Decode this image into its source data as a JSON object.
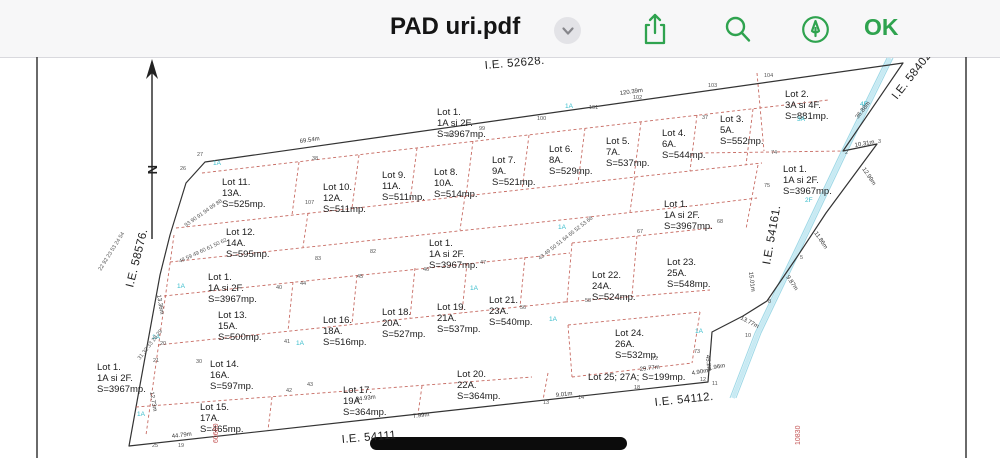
{
  "header": {
    "title": "PAD uri.pdf",
    "ok_label": "OK",
    "accent_green": "#2fa34f",
    "chevron_icon": "chevron-down-icon",
    "icons": [
      "share-icon",
      "search-icon",
      "markup-icon"
    ]
  },
  "map": {
    "north_label": "N",
    "street_labels": [
      {
        "text": "I.E. 52628.",
        "x": 485,
        "y": 12,
        "rot": -5
      },
      {
        "text": "I.E. 58402.",
        "x": 897,
        "y": 43,
        "rot": -52
      },
      {
        "text": "I.E. 58576.",
        "x": 133,
        "y": 231,
        "rot": -76
      },
      {
        "text": "I.E. 54161.",
        "x": 770,
        "y": 208,
        "rot": -80
      },
      {
        "text": "I.E. 54112.",
        "x": 655,
        "y": 349,
        "rot": -6
      },
      {
        "text": "I.E. 54111",
        "x": 342,
        "y": 386,
        "rot": -5
      }
    ],
    "red_labels": [
      {
        "text": "60660",
        "x": 218,
        "y": 386,
        "rot": -90
      },
      {
        "text": "10830",
        "x": 800,
        "y": 388,
        "rot": -90
      }
    ],
    "lot_labels": [
      {
        "x": 437,
        "y": 58,
        "lines": [
          "Lot 1.",
          "1A si 2F.",
          "S=3967mp."
        ]
      },
      {
        "x": 222,
        "y": 128,
        "lines": [
          "Lot 11.",
          "13A.",
          "S=525mp."
        ]
      },
      {
        "x": 323,
        "y": 133,
        "lines": [
          "Lot 10.",
          "12A.",
          "S=511mp."
        ]
      },
      {
        "x": 382,
        "y": 121,
        "lines": [
          "Lot 9.",
          "11A.",
          "S=511mp."
        ]
      },
      {
        "x": 434,
        "y": 118,
        "lines": [
          "Lot 8.",
          "10A.",
          "S=514mp."
        ]
      },
      {
        "x": 492,
        "y": 106,
        "lines": [
          "Lot 7.",
          "9A.",
          "S=521mp."
        ]
      },
      {
        "x": 549,
        "y": 95,
        "lines": [
          "Lot 6.",
          "8A.",
          "S=529mp."
        ]
      },
      {
        "x": 606,
        "y": 87,
        "lines": [
          "Lot 5.",
          "7A.",
          "S=537mp."
        ]
      },
      {
        "x": 662,
        "y": 79,
        "lines": [
          "Lot 4.",
          "6A.",
          "S=544mp."
        ]
      },
      {
        "x": 720,
        "y": 65,
        "lines": [
          "Lot 3.",
          "5A.",
          "S=552mp."
        ]
      },
      {
        "x": 785,
        "y": 40,
        "lines": [
          "Lot 2.",
          "3A si 4F.",
          "S=881mp."
        ]
      },
      {
        "x": 783,
        "y": 115,
        "lines": [
          "Lot 1.",
          "1A si 2F.",
          "S=3967mp."
        ]
      },
      {
        "x": 226,
        "y": 178,
        "lines": [
          "Lot 12.",
          "14A.",
          "S=595mp."
        ]
      },
      {
        "x": 664,
        "y": 150,
        "lines": [
          "Lot 1.",
          "1A si 2F.",
          "S=3967mp."
        ]
      },
      {
        "x": 429,
        "y": 189,
        "lines": [
          "Lot 1.",
          "1A si 2F.",
          "S=3967mp."
        ]
      },
      {
        "x": 208,
        "y": 223,
        "lines": [
          "Lot 1.",
          "1A si 2F.",
          "S=3967mp."
        ]
      },
      {
        "x": 592,
        "y": 221,
        "lines": [
          "Lot 22.",
          "24A.",
          "S=524mp."
        ]
      },
      {
        "x": 667,
        "y": 208,
        "lines": [
          "Lot 23.",
          "25A.",
          "S=548mp."
        ]
      },
      {
        "x": 218,
        "y": 261,
        "lines": [
          "Lot 13.",
          "15A.",
          "S=500mp."
        ]
      },
      {
        "x": 323,
        "y": 266,
        "lines": [
          "Lot 16.",
          "18A.",
          "S=516mp."
        ]
      },
      {
        "x": 382,
        "y": 258,
        "lines": [
          "Lot 18.",
          "20A.",
          "S=527mp."
        ]
      },
      {
        "x": 437,
        "y": 253,
        "lines": [
          "Lot 19.",
          "21A.",
          "S=537mp."
        ]
      },
      {
        "x": 489,
        "y": 246,
        "lines": [
          "Lot 21.",
          "23A.",
          "S=540mp."
        ]
      },
      {
        "x": 615,
        "y": 279,
        "lines": [
          "Lot 24.",
          "26A.",
          "S=532mp."
        ]
      },
      {
        "x": 210,
        "y": 310,
        "lines": [
          "Lot 14.",
          "16A.",
          "S=597mp."
        ]
      },
      {
        "x": 343,
        "y": 336,
        "lines": [
          "Lot 17.",
          "19A.",
          "S=364mp."
        ]
      },
      {
        "x": 457,
        "y": 320,
        "lines": [
          "Lot 20.",
          "22A.",
          "S=364mp."
        ]
      },
      {
        "x": 588,
        "y": 323,
        "lines": [
          "Lot 25; 27A; S=199mp."
        ]
      },
      {
        "x": 97,
        "y": 313,
        "lines": [
          "Lot 1.",
          "1A si 2F.",
          "S=3967mp."
        ]
      },
      {
        "x": 200,
        "y": 353,
        "lines": [
          "Lot 15.",
          "17A.",
          "S=465mp."
        ]
      }
    ],
    "zone_labels": [
      {
        "text": "1A",
        "x": 213,
        "y": 108
      },
      {
        "text": "1A",
        "x": 565,
        "y": 51
      },
      {
        "text": "1A",
        "x": 558,
        "y": 172
      },
      {
        "text": "1A",
        "x": 470,
        "y": 233
      },
      {
        "text": "1A",
        "x": 549,
        "y": 264
      },
      {
        "text": "1A",
        "x": 695,
        "y": 276
      },
      {
        "text": "1A",
        "x": 296,
        "y": 288
      },
      {
        "text": "1A",
        "x": 177,
        "y": 231
      },
      {
        "text": "1A",
        "x": 152,
        "y": 282
      },
      {
        "text": "1A",
        "x": 137,
        "y": 359
      },
      {
        "text": "2F",
        "x": 805,
        "y": 145
      },
      {
        "text": "3A",
        "x": 797,
        "y": 64
      },
      {
        "text": "4F",
        "x": 860,
        "y": 49
      }
    ],
    "measurements": [
      {
        "text": "69.54m",
        "x": 300,
        "y": 86,
        "rot": -8
      },
      {
        "text": "120.39m",
        "x": 620,
        "y": 38,
        "rot": -8
      },
      {
        "text": "36.88m",
        "x": 858,
        "y": 62,
        "rot": -52
      },
      {
        "text": "10.31m",
        "x": 855,
        "y": 90,
        "rot": -10
      },
      {
        "text": "12.99m",
        "x": 862,
        "y": 112,
        "rot": 56
      },
      {
        "text": "11.86m",
        "x": 814,
        "y": 176,
        "rot": 56
      },
      {
        "text": "9.87m",
        "x": 786,
        "y": 220,
        "rot": 56
      },
      {
        "text": "13.77m",
        "x": 740,
        "y": 262,
        "rot": 28
      },
      {
        "text": "15.01m",
        "x": 749,
        "y": 215,
        "rot": 83
      },
      {
        "text": "9.01m",
        "x": 556,
        "y": 340,
        "rot": -7
      },
      {
        "text": "34.93m",
        "x": 356,
        "y": 344,
        "rot": -7
      },
      {
        "text": "29.77m",
        "x": 640,
        "y": 314,
        "rot": -7
      },
      {
        "text": "44.79m",
        "x": 172,
        "y": 381,
        "rot": -7
      },
      {
        "text": "7.99m",
        "x": 413,
        "y": 361,
        "rot": -7
      },
      {
        "text": "4.90m",
        "x": 692,
        "y": 318,
        "rot": -10
      },
      {
        "text": "1.96m",
        "x": 709,
        "y": 313,
        "rot": -10
      },
      {
        "text": "13.36m",
        "x": 157,
        "y": 238,
        "rot": 80
      },
      {
        "text": "12.73m",
        "x": 150,
        "y": 335,
        "rot": 80
      },
      {
        "text": "45.2m",
        "x": 706,
        "y": 298,
        "rot": 85
      }
    ],
    "point_numbers": [
      {
        "text": "27",
        "x": 197,
        "y": 99
      },
      {
        "text": "26",
        "x": 180,
        "y": 113
      },
      {
        "text": "36",
        "x": 446,
        "y": 80
      },
      {
        "text": "37",
        "x": 702,
        "y": 62
      },
      {
        "text": "103",
        "x": 708,
        "y": 30
      },
      {
        "text": "104",
        "x": 764,
        "y": 20
      },
      {
        "text": "99",
        "x": 479,
        "y": 73
      },
      {
        "text": "100",
        "x": 537,
        "y": 63
      },
      {
        "text": "101",
        "x": 589,
        "y": 52
      },
      {
        "text": "102",
        "x": 633,
        "y": 42
      },
      {
        "text": "74",
        "x": 771,
        "y": 97
      },
      {
        "text": "75",
        "x": 764,
        "y": 130
      },
      {
        "text": "68",
        "x": 717,
        "y": 166
      },
      {
        "text": "67",
        "x": 637,
        "y": 176
      },
      {
        "text": "107",
        "x": 305,
        "y": 147
      },
      {
        "text": "38",
        "x": 312,
        "y": 103
      },
      {
        "text": "40",
        "x": 276,
        "y": 232
      },
      {
        "text": "44",
        "x": 300,
        "y": 228
      },
      {
        "text": "45",
        "x": 357,
        "y": 221
      },
      {
        "text": "46",
        "x": 423,
        "y": 214
      },
      {
        "text": "47",
        "x": 480,
        "y": 207
      },
      {
        "text": "41",
        "x": 284,
        "y": 286
      },
      {
        "text": "42",
        "x": 286,
        "y": 335
      },
      {
        "text": "43",
        "x": 307,
        "y": 329
      },
      {
        "text": "56",
        "x": 520,
        "y": 252
      },
      {
        "text": "58",
        "x": 585,
        "y": 245
      },
      {
        "text": "82",
        "x": 370,
        "y": 196
      },
      {
        "text": "83",
        "x": 315,
        "y": 203
      },
      {
        "text": "72",
        "x": 652,
        "y": 303
      },
      {
        "text": "73",
        "x": 694,
        "y": 296
      },
      {
        "text": "2",
        "x": 845,
        "y": 97
      },
      {
        "text": "3",
        "x": 878,
        "y": 86
      },
      {
        "text": "5",
        "x": 800,
        "y": 202
      },
      {
        "text": "8",
        "x": 768,
        "y": 246
      },
      {
        "text": "11",
        "x": 712,
        "y": 328
      },
      {
        "text": "12",
        "x": 700,
        "y": 324
      },
      {
        "text": "13",
        "x": 543,
        "y": 347
      },
      {
        "text": "14",
        "x": 578,
        "y": 342
      },
      {
        "text": "18",
        "x": 634,
        "y": 332
      },
      {
        "text": "20",
        "x": 160,
        "y": 288
      },
      {
        "text": "21",
        "x": 153,
        "y": 305
      },
      {
        "text": "30",
        "x": 196,
        "y": 306
      },
      {
        "text": "25",
        "x": 152,
        "y": 390
      },
      {
        "text": "19",
        "x": 178,
        "y": 390
      },
      {
        "text": "10",
        "x": 745,
        "y": 280
      }
    ],
    "clusters": [
      {
        "text": "93 90 91 94 89 88",
        "x": 186,
        "y": 170,
        "rot": -35
      },
      {
        "text": "48 59 49 60 61 50 62",
        "x": 180,
        "y": 206,
        "rot": -25
      },
      {
        "text": "22 92 23 53 24 54",
        "x": 101,
        "y": 214,
        "rot": -58
      },
      {
        "text": "43 49 50 51 64 65 52 53 66",
        "x": 540,
        "y": 203,
        "rot": -38
      },
      {
        "text": "31 32 33 28 29",
        "x": 140,
        "y": 303,
        "rot": -52
      }
    ]
  }
}
